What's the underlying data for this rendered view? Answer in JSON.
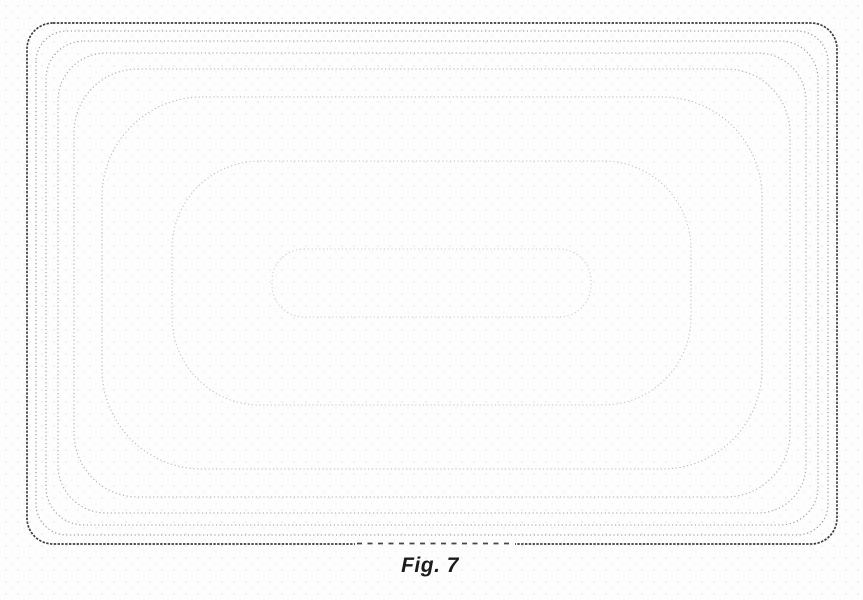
{
  "figure": {
    "label": "Fig. 7"
  },
  "drawing": {
    "canvas": {
      "width": 863,
      "height": 600
    },
    "line_style": "dotted",
    "contours": [
      {
        "name": "contour-1-outer",
        "x": 27,
        "y": 23,
        "w": 810,
        "h": 521,
        "r": 26,
        "color": "#3d3d3d",
        "sw": 1.7,
        "dash": "2.4 1.4"
      },
      {
        "name": "contour-2",
        "x": 36,
        "y": 31,
        "w": 792,
        "h": 504,
        "r": 31,
        "color": "#909090",
        "sw": 1.1,
        "dash": "1.2 2.6"
      },
      {
        "name": "contour-3",
        "x": 46,
        "y": 41,
        "w": 772,
        "h": 484,
        "r": 38,
        "color": "#9a9a9a",
        "sw": 1.1,
        "dash": "1.2 2.6"
      },
      {
        "name": "contour-4",
        "x": 58,
        "y": 53,
        "w": 748,
        "h": 460,
        "r": 48,
        "color": "#a4a4a4",
        "sw": 1.1,
        "dash": "1.2 2.6"
      },
      {
        "name": "contour-5",
        "x": 74,
        "y": 69,
        "w": 716,
        "h": 428,
        "r": 64,
        "color": "#aeaeae",
        "sw": 1.1,
        "dash": "1.2 2.6"
      },
      {
        "name": "contour-6",
        "x": 102,
        "y": 97,
        "w": 660,
        "h": 372,
        "r": 100,
        "color": "#b9b9b9",
        "sw": 1.1,
        "dash": "1.2 2.6"
      },
      {
        "name": "contour-7",
        "x": 172,
        "y": 161,
        "w": 519,
        "h": 244,
        "r": 88,
        "color": "#c3c3c3",
        "sw": 1.1,
        "dash": "1.2 2.6"
      },
      {
        "name": "contour-8-inner",
        "x": 272,
        "y": 249,
        "w": 319,
        "h": 68,
        "r": 32,
        "color": "#cdcdcd",
        "sw": 1.1,
        "dash": "1.2 2.6"
      }
    ],
    "bottom_dashed_segment": {
      "x1": 357,
      "x2": 513,
      "y": 543.5,
      "color": "#454545",
      "sw": 1.7,
      "dash": "5 5.5",
      "mask_color": "#fcfcfc"
    }
  }
}
